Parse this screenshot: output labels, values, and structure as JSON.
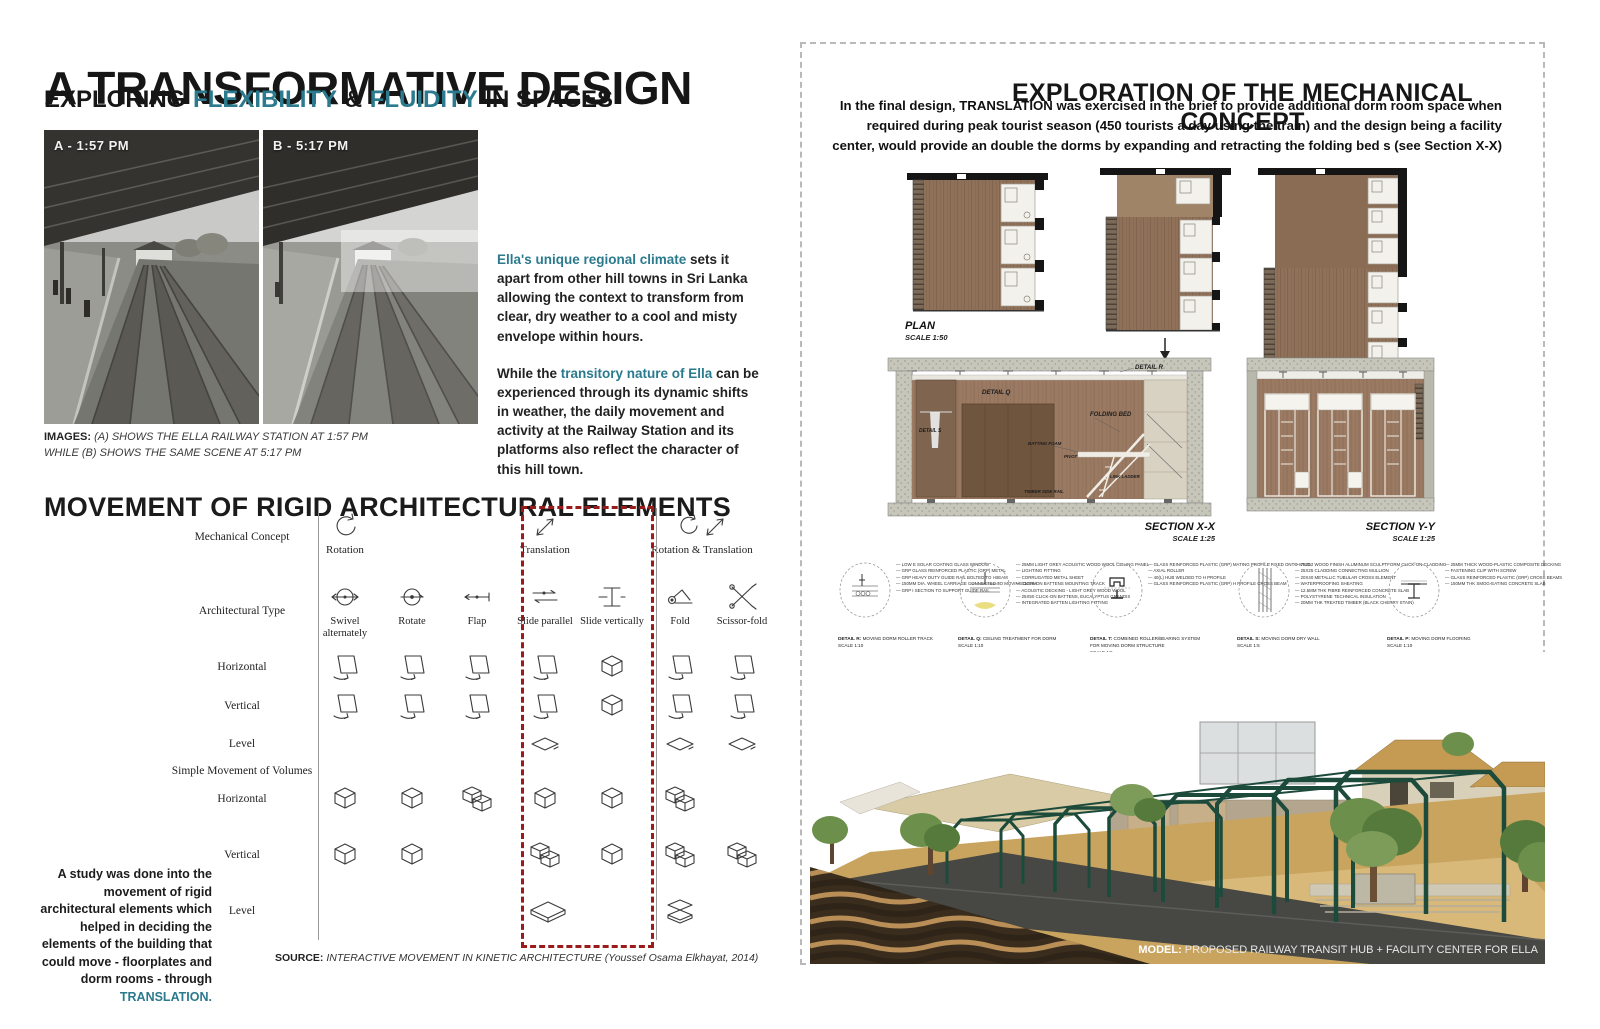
{
  "colors": {
    "accent_teal": "#2b7a8e",
    "highlight_red": "#9b1b1b",
    "ink": "#1a1a1a",
    "wood_brown": "#8f7058",
    "cardboard_tan": "#c49a5e",
    "frame_green": "#1c4a3b"
  },
  "header": {
    "title": "A TRANSFORMATIVE DESIGN",
    "subtitle_pre": "EXPLORING",
    "subtitle_flex": "FLEXIBILITY",
    "subtitle_amp": "&",
    "subtitle_fluid": "FLUIDITY",
    "subtitle_post": "IN SPACES"
  },
  "photos": {
    "items": [
      {
        "label": "A - 1:57 PM"
      },
      {
        "label": "B - 5:17 PM"
      }
    ],
    "caption_bold": "IMAGES:",
    "caption_line1": " (A) SHOWS THE ELLA RAILWAY STATION AT 1:57 PM",
    "caption_line2": "WHILE (B) SHOWS THE SAME SCENE AT 5:17 PM"
  },
  "intro": {
    "p1_highlight": "Ella's unique regional climate",
    "p1_rest": " sets it apart from other hill towns in Sri Lanka allowing the context to transform from clear, dry weather to a cool and misty envelope within hours.",
    "p2_pre": "While the ",
    "p2_highlight": "transitory nature of Ella",
    "p2_rest": " can be experienced through its dynamic shifts in weather, the daily movement and activity at the Railway Station and its platforms also reflect the character of this hill town."
  },
  "movement": {
    "title": "MOVEMENT OF RIGID ARCHITECTURAL ELEMENTS",
    "concept_label": "Mechanical Concept",
    "type_label": "Architectural Type",
    "volumes_label": "Simple Movement of Volumes",
    "concepts": [
      {
        "label": "Rotation",
        "icon": "rotation-icon"
      },
      {
        "label": "Translation",
        "icon": "translation-icon"
      },
      {
        "label": "Rotation & Translation",
        "icon": "rotation-translation-icon"
      }
    ],
    "types": [
      {
        "label": "Swivel alternately",
        "icon": "swivel-icon"
      },
      {
        "label": "Rotate",
        "icon": "rotate-icon"
      },
      {
        "label": "Flap",
        "icon": "flap-icon"
      },
      {
        "label": "Slide parallel",
        "icon": "slide-parallel-icon"
      },
      {
        "label": "Slide vertically",
        "icon": "slide-vertical-icon"
      },
      {
        "label": "Fold",
        "icon": "fold-icon"
      },
      {
        "label": "Scissor-fold",
        "icon": "scissor-fold-icon"
      }
    ],
    "rows": [
      {
        "label": "Horizontal",
        "cells": [
          "panel",
          "panel",
          "panel",
          "panel",
          "cube",
          "panel",
          "panel"
        ]
      },
      {
        "label": "Vertical",
        "cells": [
          "panel",
          "panel",
          "panel",
          "panel",
          "cube",
          "panel",
          "panel"
        ]
      },
      {
        "label": "Level",
        "cells": [
          null,
          null,
          null,
          "slab",
          null,
          "slab",
          "slab"
        ]
      },
      {
        "label": "Horizontal",
        "cells": [
          "cube",
          "cube",
          "cubes",
          "cube",
          "cube",
          "cubes",
          null
        ]
      },
      {
        "label": "Vertical",
        "cells": [
          "cube",
          "cube",
          null,
          "cubes",
          "cube",
          "cubes",
          "cubes"
        ]
      },
      {
        "label": "Level",
        "cells": [
          null,
          null,
          null,
          "slab-big",
          null,
          "slabs",
          null
        ]
      }
    ],
    "study_pre": "A study was done into the movement of rigid architectural elements which helped in deciding the elements of the building that could move - floorplates and dorm rooms - through ",
    "study_highlight": "TRANSLATION.",
    "source_bold": "SOURCE:",
    "source_italic": " INTERACTIVE MOVEMENT IN KINETIC ARCHITECTURE (Youssef Osama Elkhayat, 2014)"
  },
  "exploration": {
    "title": "EXPLORATION OF THE MECHANICAL CONCEPT",
    "paragraph": "In the final design, TRANSLATION was exercised in the brief to provide additional dorm room space when required during peak tourist season (450 tourists a day using the train) and the design being a facility center, would provide an double the dorms by expanding and retracting the folding bed s (see Section X-X)",
    "plan_label": "PLAN",
    "plan_scale": "SCALE 1:50",
    "section_x": {
      "label": "SECTION X-X",
      "scale": "SCALE 1:25",
      "annotations": {
        "detail_r": "DETAIL R",
        "detail_q": "DETAIL Q",
        "detail_s": "DETAIL S",
        "folding_bed": "FOLDING BED",
        "batting_foam": "BATTING FOAM",
        "pivot": "PIVOT",
        "link_ladder": "LINK LADDER",
        "timber_side_rail": "TIMBER SIDE RAIL"
      }
    },
    "section_y": {
      "label": "SECTION Y-Y",
      "scale": "SCALE 1:25"
    },
    "details": [
      {
        "name": "DETAIL R:",
        "desc": "MOVING DORM ROLLER TRACK",
        "scale": "SCALE 1:10",
        "notes": [
          "LOW E SOLAR COATING GLASS WINDOW",
          "GRP GLASS REINFORCED PLASTIC (GRP) METAL",
          "GRP HEAVY DUTY GUIDE RAIL BOLTED TO I-BEAM",
          "150MM DIA. WHEEL CARRIAGE CONNECTED TO MOVING DORM",
          "GRP I SECTION TO SUPPORT GUIDE RAIL"
        ]
      },
      {
        "name": "DETAIL Q:",
        "desc": "CEILING TREATMENT FOR DORM",
        "scale": "SCALE 1:10",
        "notes": [
          "25MM LIGHT GREY ACOUSTIC WOOD WOOL CEILING PANEL",
          "LIGHTING FITTING",
          "CORRUGATED METAL SHEET",
          "CLICK-ON BATTENS MOUNTING TRACK",
          "ACOUSTIC DECKING - LIGHT GREY WOOD WOOL",
          "25X50 CLICK-ON BATTENS, EUCALYPTUS GRANDIS",
          "INTEGRATED BATTEN LIGHTING FITTING"
        ]
      },
      {
        "name": "DETAIL T:",
        "desc": "COMBINED ROLLER/BEARING SYSTEM FOR MOVING DORM STRUCTURE",
        "scale": "SCALE 1:5",
        "notes": [
          "GLASS REINFORCED PLASTIC (GRP) MATING PROFILE FIXED ONTO STUD",
          "AXIAL ROLLER",
          "40(L) HUB WELDED TO H PROFILE",
          "GLASS REINFORCED PLASTIC (GRP) H PROFILE CROSS BEAM"
        ]
      },
      {
        "name": "DETAIL S:",
        "desc": "MOVING DORM DRY WALL",
        "scale": "SCALE 1:5",
        "notes": [
          "75X12 WOOD FINISH ALUMINUM SCULPTFORM CLICK-ON CLADDING",
          "25X25 CLADDING CONNECTING MULLION",
          "20X40 METALLIC TUBULAR CROSS ELEMENT",
          "WATERPROOFING SHEATING",
          "12.5MM THK FIBRE REINFORCED CONCRETE SLAB",
          "POLYSTYRENE TECHNICAL INSULATION",
          "20MM THK TREATED TIMBER (BLACK CHERRY STAIN)"
        ]
      },
      {
        "name": "DETAIL P:",
        "desc": "MOVING DORM FLOORING",
        "scale": "SCALE 1:10",
        "notes": [
          "25MM THICK WOOD-PLASTIC COMPOSITE DECKING",
          "FASTENING CLIP WITH SCREW",
          "GLASS REINFORCED PLASTIC (GRP) CROSS BEAMS",
          "150MM THK SMOG-EATING CONCRETE SLAB"
        ]
      }
    ],
    "model_caption_bold": "MODEL:",
    "model_caption_rest": " PROPOSED RAILWAY TRANSIT HUB + FACILITY CENTER FOR ELLA"
  }
}
